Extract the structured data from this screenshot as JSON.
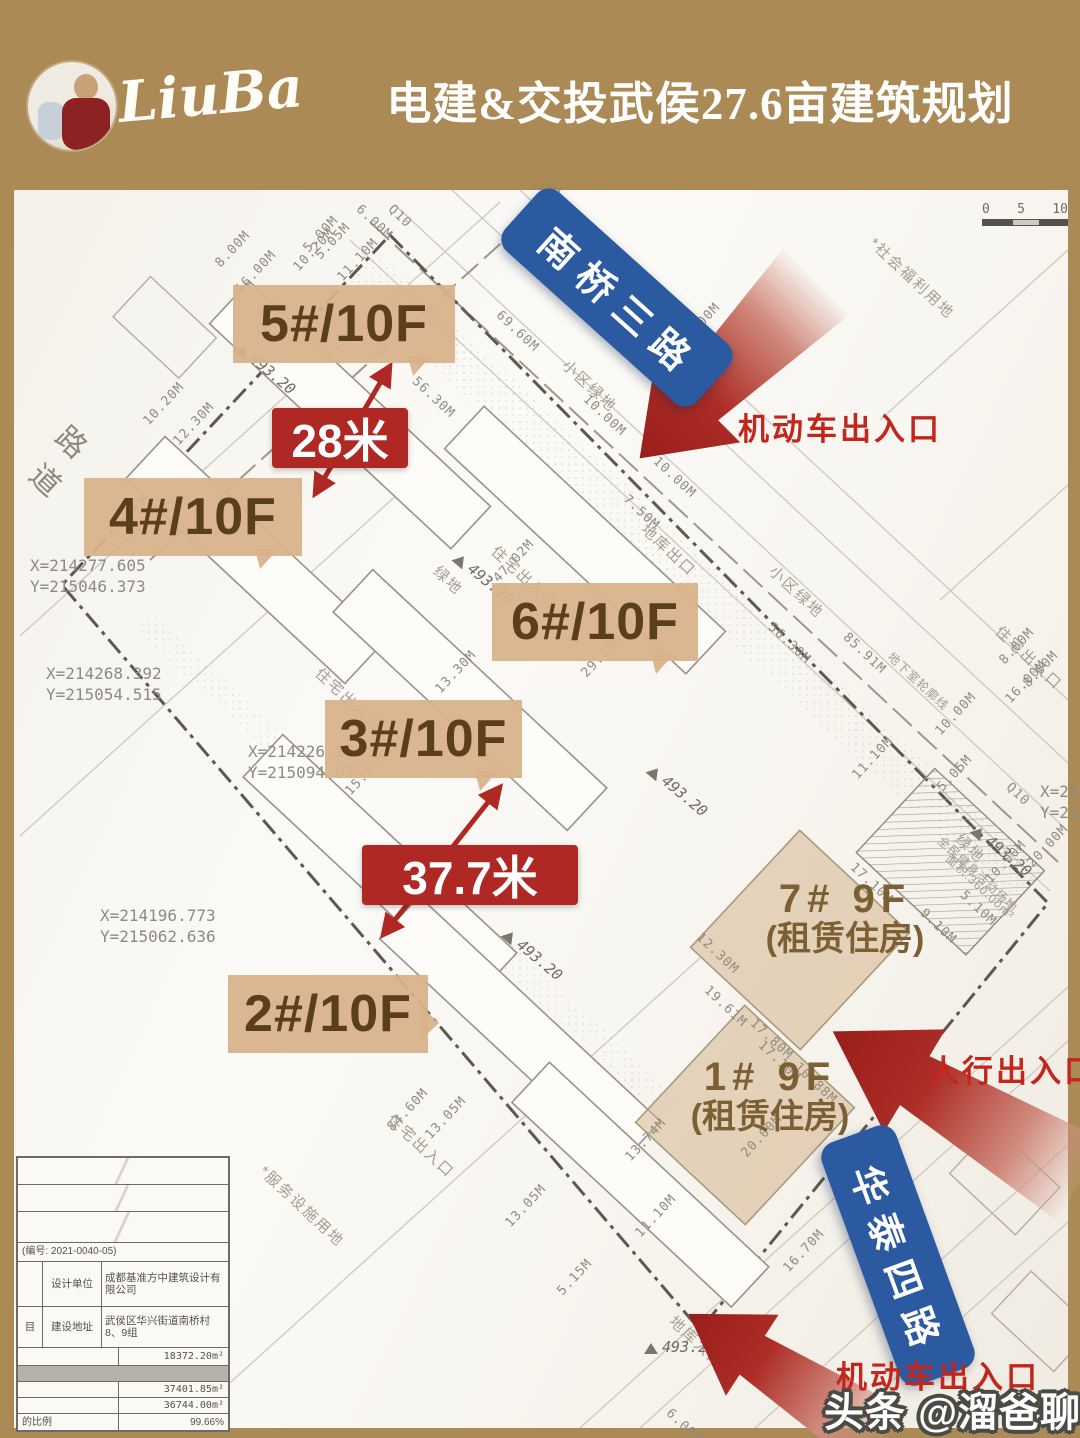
{
  "header": {
    "logo_text": "LiuBa",
    "title": "电建&交投武侯27.6亩建筑规划"
  },
  "colors": {
    "frame_tan": "#ab8a55",
    "accent_red": "#b02823",
    "banner_blue": "#2b5aa0",
    "callout_bg": "#d8b28c",
    "callout_text": "#5a4018"
  },
  "map": {
    "scalebar": {
      "ticks": [
        "0",
        "5",
        "10"
      ]
    },
    "banners": {
      "nanqiao": "南桥三路",
      "huatai": "华泰四路"
    },
    "entrances": {
      "top": "机动车出入口",
      "mid": "人行出入口",
      "bottom": "机动车出入口"
    },
    "buildings": [
      {
        "label": "5#/10F",
        "x": 233,
        "y": 285,
        "w": 222,
        "cls": "tail-br"
      },
      {
        "label": "4#/10F",
        "x": 84,
        "y": 478,
        "w": 218,
        "cls": "tail-br"
      },
      {
        "label": "6#/10F",
        "x": 492,
        "y": 583,
        "w": 206,
        "cls": "tail-br"
      },
      {
        "label": "3#/10F",
        "x": 325,
        "y": 700,
        "w": 197,
        "cls": "tail-br"
      },
      {
        "label": "2#/10F",
        "x": 228,
        "y": 975,
        "w": 200,
        "cls": "tail-r"
      }
    ],
    "rentals": [
      {
        "l1": "7#  9F",
        "l2": "(租赁住房)",
        "x": 845,
        "y": 878
      },
      {
        "l1": "1#  9F",
        "l2": "(租赁住房)",
        "x": 770,
        "y": 1056
      }
    ],
    "measurements": [
      {
        "label": "28米",
        "x": 272,
        "y": 408,
        "w": 136
      },
      {
        "label": "37.7米",
        "x": 362,
        "y": 845,
        "w": 216
      }
    ],
    "coordinates": [
      {
        "xl": "X=214277.605",
        "yl": "Y=215046.373",
        "x": 30,
        "y": 556
      },
      {
        "xl": "X=214268.392",
        "yl": "Y=215054.515",
        "x": 46,
        "y": 664
      },
      {
        "xl": "X=214226.195",
        "yl": "Y=215094.035",
        "x": 248,
        "y": 742
      },
      {
        "xl": "X=214196.773",
        "yl": "Y=215062.636",
        "x": 100,
        "y": 906
      },
      {
        "xl": "X=214",
        "yl": "Y=215",
        "x": 1040,
        "y": 782
      }
    ],
    "elevations": [
      {
        "t": "493.20",
        "x": 238,
        "y": 336,
        "r": 40
      },
      {
        "t": "493.20",
        "x": 456,
        "y": 546,
        "r": 40
      },
      {
        "t": "493.20",
        "x": 650,
        "y": 758,
        "r": 40
      },
      {
        "t": "493.20",
        "x": 974,
        "y": 818,
        "r": 40
      },
      {
        "t": "493.20",
        "x": 505,
        "y": 922,
        "r": 40
      },
      {
        "t": "493.20",
        "x": 644,
        "y": 1338,
        "r": 0
      }
    ],
    "zones": [
      {
        "t": "*社会福利用地",
        "x": 872,
        "y": 230,
        "r": 43
      },
      {
        "t": "小区绿地",
        "x": 565,
        "y": 352,
        "r": 43
      },
      {
        "t": "小区绿地",
        "x": 772,
        "y": 558,
        "r": 43
      },
      {
        "t": "绿地",
        "x": 436,
        "y": 558,
        "r": 43
      },
      {
        "t": "绿地",
        "x": 958,
        "y": 826,
        "r": 43
      },
      {
        "t": "住宅出入口",
        "x": 494,
        "y": 538,
        "r": 43
      },
      {
        "t": "住宅出入口",
        "x": 318,
        "y": 660,
        "r": 43
      },
      {
        "t": "住宅出入口",
        "x": 998,
        "y": 618,
        "r": 43
      },
      {
        "t": "住宅出入口",
        "x": 390,
        "y": 1106,
        "r": 43
      },
      {
        "t": "地库出口",
        "x": 644,
        "y": 516,
        "r": 43
      },
      {
        "t": "地库入口",
        "x": 672,
        "y": 1308,
        "r": 43
      },
      {
        "t": "*服务设施用地",
        "x": 262,
        "y": 1158,
        "r": 43
      },
      {
        "t": "地下室轮廓线",
        "x": 890,
        "y": 646,
        "r": 43,
        "cls": "sm"
      },
      {
        "t": "全民健身活动场地",
        "x": 940,
        "y": 830,
        "r": 43,
        "cls": "sm"
      },
      {
        "t": "面积:360.00m²",
        "x": 948,
        "y": 848,
        "r": 43,
        "cls": "sm"
      },
      {
        "t": "道",
        "x": 36,
        "y": 446,
        "r": 43,
        "cls": "big"
      },
      {
        "t": "路",
        "x": 62,
        "y": 408,
        "r": 43,
        "cls": "big"
      }
    ],
    "dim_labels": [
      {
        "t": "5.00M",
        "x": 306,
        "y": 243,
        "r": -47
      },
      {
        "t": "6.00M",
        "x": 358,
        "y": 200,
        "r": 43
      },
      {
        "t": "Q10",
        "x": 390,
        "y": 200,
        "r": 43
      },
      {
        "t": "10.20M",
        "x": 296,
        "y": 262,
        "r": -47
      },
      {
        "t": "5.05M",
        "x": 318,
        "y": 250,
        "r": -47
      },
      {
        "t": "11.10M",
        "x": 340,
        "y": 272,
        "r": -47
      },
      {
        "t": "8.00M",
        "x": 218,
        "y": 258,
        "r": -47
      },
      {
        "t": "16.00M",
        "x": 238,
        "y": 284,
        "r": -47
      },
      {
        "t": "10.20M",
        "x": 146,
        "y": 416,
        "r": -47
      },
      {
        "t": "12.30M",
        "x": 176,
        "y": 436,
        "r": -47
      },
      {
        "t": "69.60M",
        "x": 498,
        "y": 306,
        "r": 43
      },
      {
        "t": "56.30M",
        "x": 414,
        "y": 372,
        "r": 43
      },
      {
        "t": "8.00M",
        "x": 688,
        "y": 330,
        "r": -47
      },
      {
        "t": "10.00M",
        "x": 585,
        "y": 390,
        "r": 43
      },
      {
        "t": "10.00M",
        "x": 655,
        "y": 452,
        "r": 43
      },
      {
        "t": "7.50M",
        "x": 625,
        "y": 490,
        "r": 43
      },
      {
        "t": "56.30M",
        "x": 770,
        "y": 618,
        "r": 43
      },
      {
        "t": "85.91M",
        "x": 845,
        "y": 628,
        "r": 43
      },
      {
        "t": "8.00M",
        "x": 1002,
        "y": 655,
        "r": -47
      },
      {
        "t": "8.00M",
        "x": 1026,
        "y": 678,
        "r": -47
      },
      {
        "t": "16.00M",
        "x": 1008,
        "y": 694,
        "r": -47
      },
      {
        "t": "10.00M",
        "x": 938,
        "y": 726,
        "r": -47
      },
      {
        "t": "Q10",
        "x": 1008,
        "y": 778,
        "r": 43
      },
      {
        "t": "5.05M",
        "x": 940,
        "y": 782,
        "r": -47
      },
      {
        "t": "11.10M",
        "x": 855,
        "y": 770,
        "r": -47
      },
      {
        "t": "20.00M",
        "x": 1030,
        "y": 858,
        "r": -47
      },
      {
        "t": "10.00M",
        "x": 988,
        "y": 874,
        "r": -47
      },
      {
        "t": "5.10M",
        "x": 962,
        "y": 886,
        "r": 43
      },
      {
        "t": "9.10M",
        "x": 922,
        "y": 904,
        "r": 43
      },
      {
        "t": "17.10M",
        "x": 852,
        "y": 858,
        "r": 43
      },
      {
        "t": "12.30M",
        "x": 698,
        "y": 928,
        "r": 43
      },
      {
        "t": "19.61M",
        "x": 706,
        "y": 981,
        "r": 43
      },
      {
        "t": "17.80M",
        "x": 752,
        "y": 1014,
        "r": 43
      },
      {
        "t": "17.10M",
        "x": 760,
        "y": 1036,
        "r": 43
      },
      {
        "t": "10.88M",
        "x": 796,
        "y": 1058,
        "r": 43
      },
      {
        "t": "20.00M",
        "x": 744,
        "y": 1148,
        "r": -47
      },
      {
        "t": "13.74M",
        "x": 628,
        "y": 1152,
        "r": -47
      },
      {
        "t": "84.60M",
        "x": 390,
        "y": 1122,
        "r": -47
      },
      {
        "t": "13.05M",
        "x": 428,
        "y": 1130,
        "r": -47
      },
      {
        "t": "13.05M",
        "x": 508,
        "y": 1218,
        "r": -47
      },
      {
        "t": "11.10M",
        "x": 638,
        "y": 1228,
        "r": -47
      },
      {
        "t": "5.15M",
        "x": 560,
        "y": 1286,
        "r": -47
      },
      {
        "t": "29.10M",
        "x": 584,
        "y": 668,
        "r": -47
      },
      {
        "t": "13.30M",
        "x": 438,
        "y": 684,
        "r": -47
      },
      {
        "t": "15.56M",
        "x": 348,
        "y": 786,
        "r": -47
      },
      {
        "t": "47.02M",
        "x": 496,
        "y": 573,
        "r": -47
      },
      {
        "t": "16.70M",
        "x": 786,
        "y": 1263,
        "r": -47
      },
      {
        "t": "6.00M",
        "x": 668,
        "y": 1404,
        "r": 43
      }
    ],
    "info_table": {
      "code": "(编号: 2021-0040-05)",
      "row1": {
        "c1": "",
        "c2": "设计单位",
        "c3": "成都基准方中建筑设计有限公司"
      },
      "row2": {
        "c1": "目",
        "c2": "建设地址",
        "c3": "武侯区华兴街道南桥村8、9组"
      },
      "values": [
        "18372.20m²",
        "37401.85m²",
        "36744.00m²"
      ],
      "ratio_label": "的比例",
      "ratio_value": "99.66%"
    }
  },
  "watermark": {
    "text": "头条 @溜爸聊学区"
  }
}
